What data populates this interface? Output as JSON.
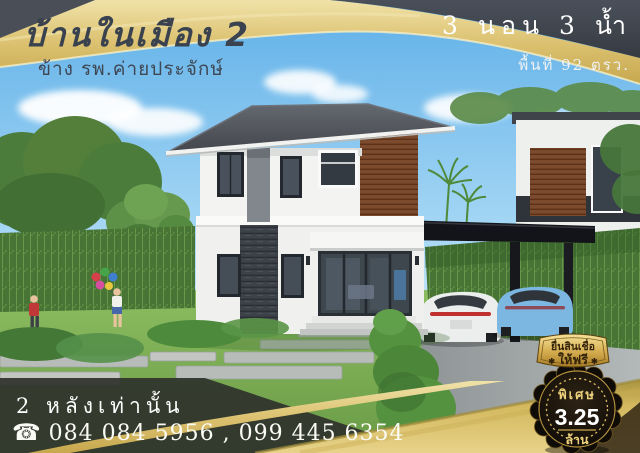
{
  "poster": {
    "header": {
      "project_name": "บ้านในเมือง 2",
      "location_line": "ข้าง รพ.ค่ายประจักษ์",
      "spec_rooms": "3 นอน 3 น้ำ",
      "spec_area": "พื้นที่ 92 ตรว."
    },
    "footer": {
      "availability": "2 หลังเท่านั้น",
      "phone_icon": "☎",
      "phone_numbers": "084 084 5956 , 099 445 6354"
    },
    "promo_badge": {
      "ribbon_line1": "ยื่นสินเชื่อ",
      "ribbon_line2": "ให้ฟรี",
      "ribbon_star": "✱",
      "seal_label": "พิเศษ",
      "seal_price": "3.25",
      "seal_unit": "ล้าน"
    },
    "colors": {
      "gold": "#dcc271",
      "gold_light": "#f2e5ae",
      "gold_deep": "#c7a84e",
      "charcoal_banner": "#41464e",
      "title_text": "#39424e",
      "white_text": "#ffffff",
      "footer_panel": "#2f332c",
      "seal_background": "#14100a",
      "seal_gold_text": "#ecd07c",
      "sky_top": "#5fb0e8",
      "sky_bottom": "#cdeafb",
      "lawn_green": "#7fae55",
      "hedge_green": "#57863f",
      "house_wall": "#f3f4f2",
      "roof_gray": "#4b4f56",
      "wood_panel": "#7c4a2d",
      "car_white": "#eceeee",
      "car_blue": "#7cb7e2"
    }
  }
}
